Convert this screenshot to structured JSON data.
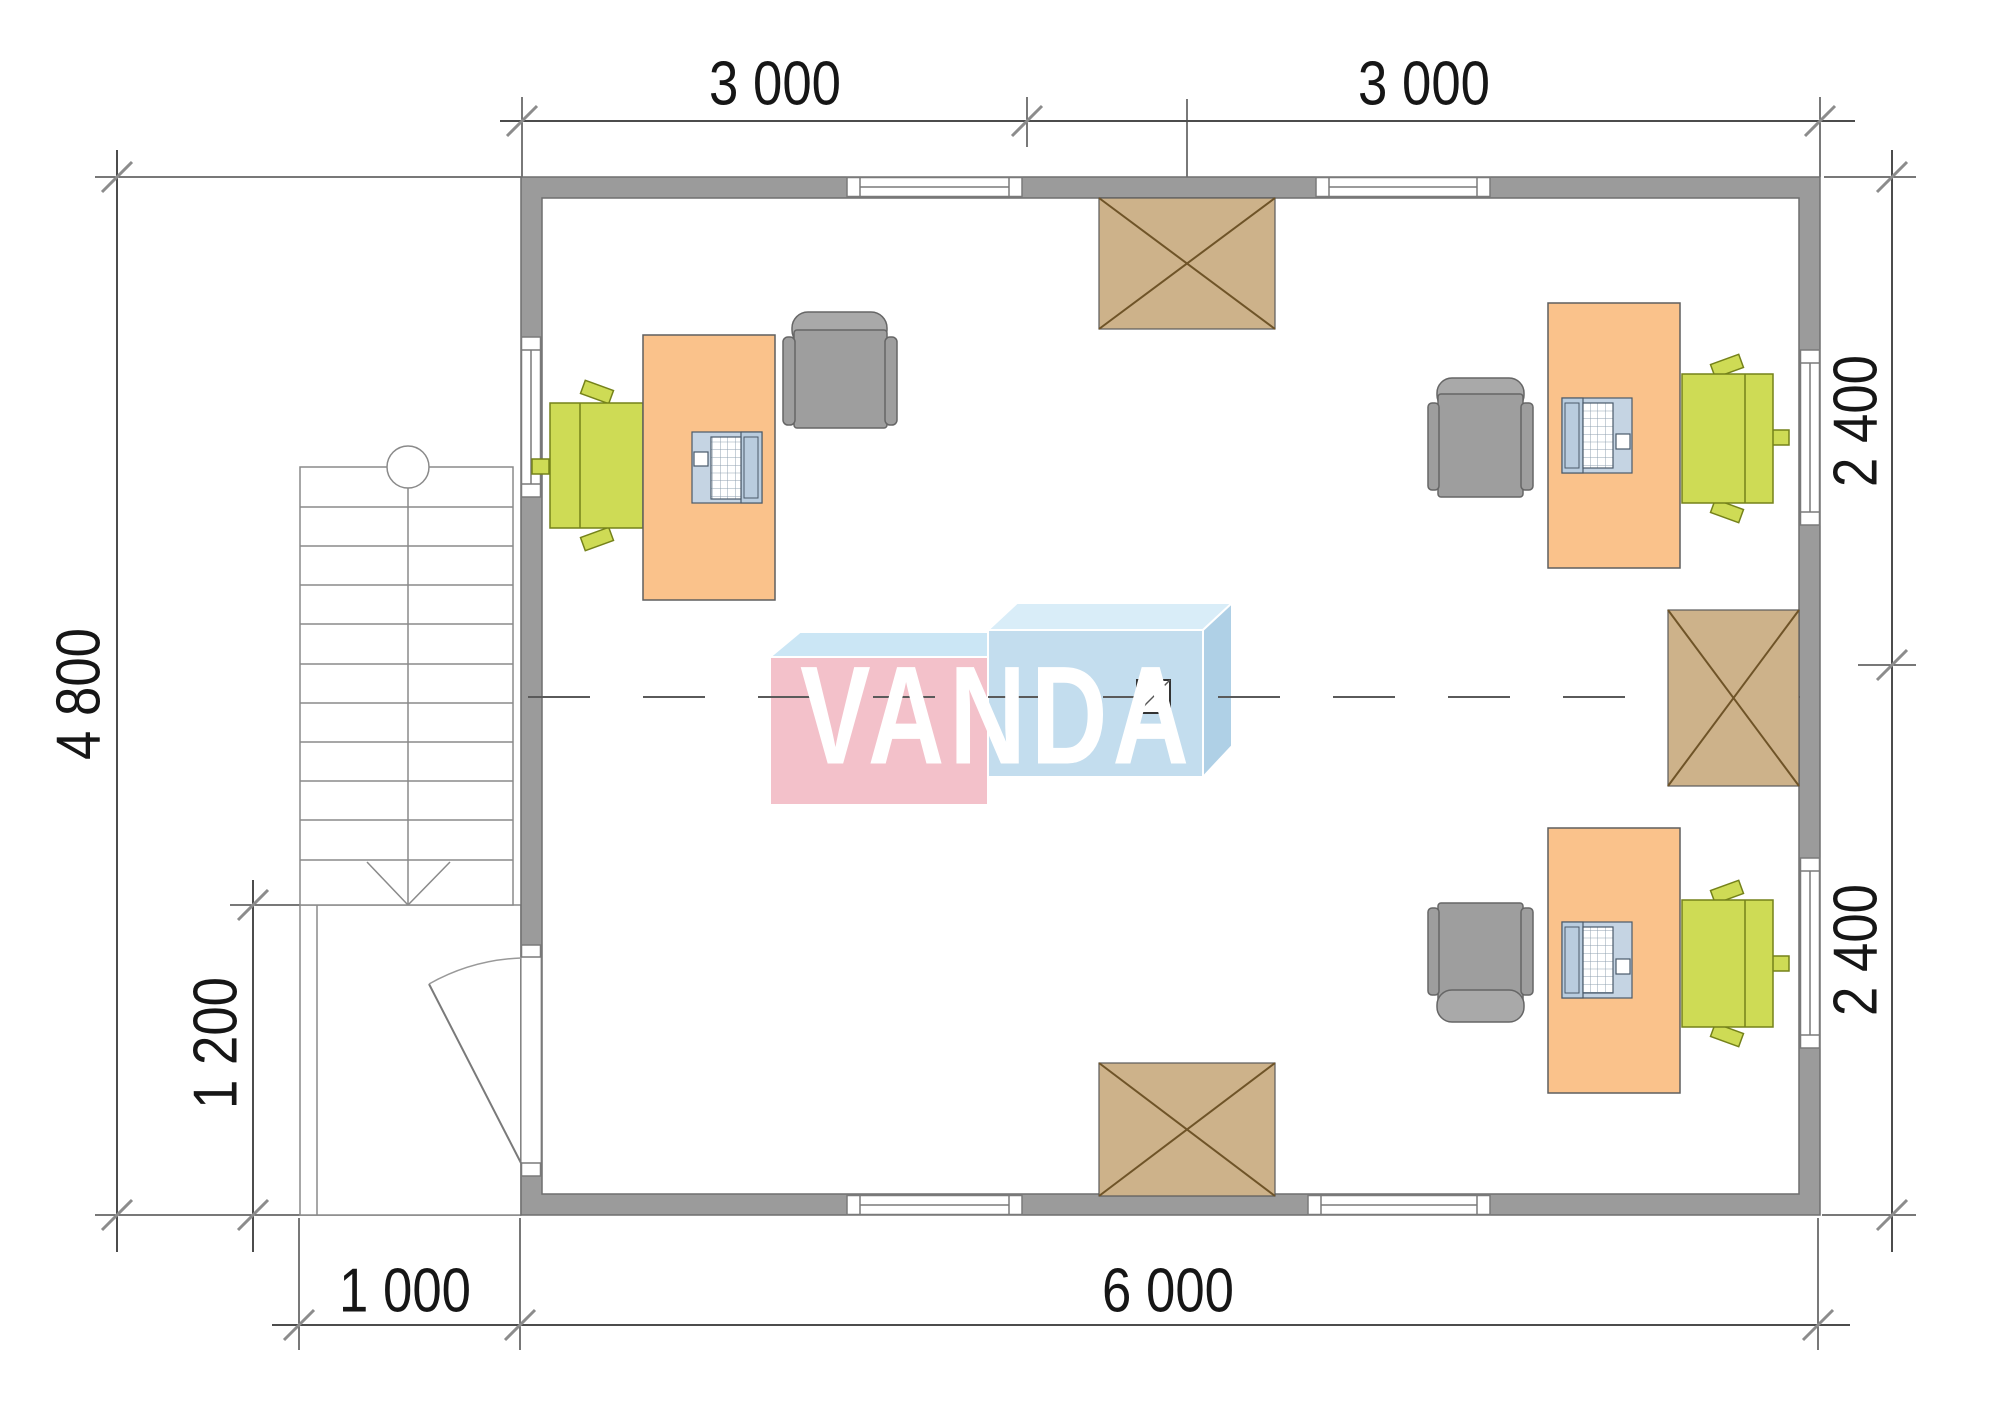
{
  "drawing_type": "office-floor-plan",
  "watermark": {
    "text": "VANDA"
  },
  "dimensions": {
    "top": [
      "3 000",
      "3 000"
    ],
    "right": [
      "2 400",
      "2 400"
    ],
    "left": "4 800",
    "porch_height": "1 200",
    "porch_width": "1 000",
    "bottom": "6 000"
  },
  "colors": {
    "wall": "#9B9B9B",
    "wall-edge": "#6F6F6F",
    "frame": "#7A7A7A",
    "line": "#4C4C4C",
    "tick": "#8C8C8C",
    "stair": "#8A8A8A",
    "desk": "#FAC28B",
    "desk-border": "#5F5F5F",
    "chair": "#CEDB55",
    "chair-border": "#75821A",
    "gchair": "#9E9E9E",
    "gchair-back": "#A9A9A9",
    "gchair-border": "#666666",
    "box": "#CDB28A",
    "box-border": "#5A5A5A",
    "box-cross": "#6F5428",
    "laptop-body": "#C5D4E3",
    "laptop-screen": "#B9CCDE",
    "laptop-border": "#4A5A6A",
    "logo-pink": "#F3C1CA",
    "logo-top-l": "#CBE6F5",
    "logo-blue": "#C3DDEE",
    "logo-top-r": "#D9EDF8",
    "logo-side": "#AFD0E6",
    "axis": "#5A5A5A"
  }
}
